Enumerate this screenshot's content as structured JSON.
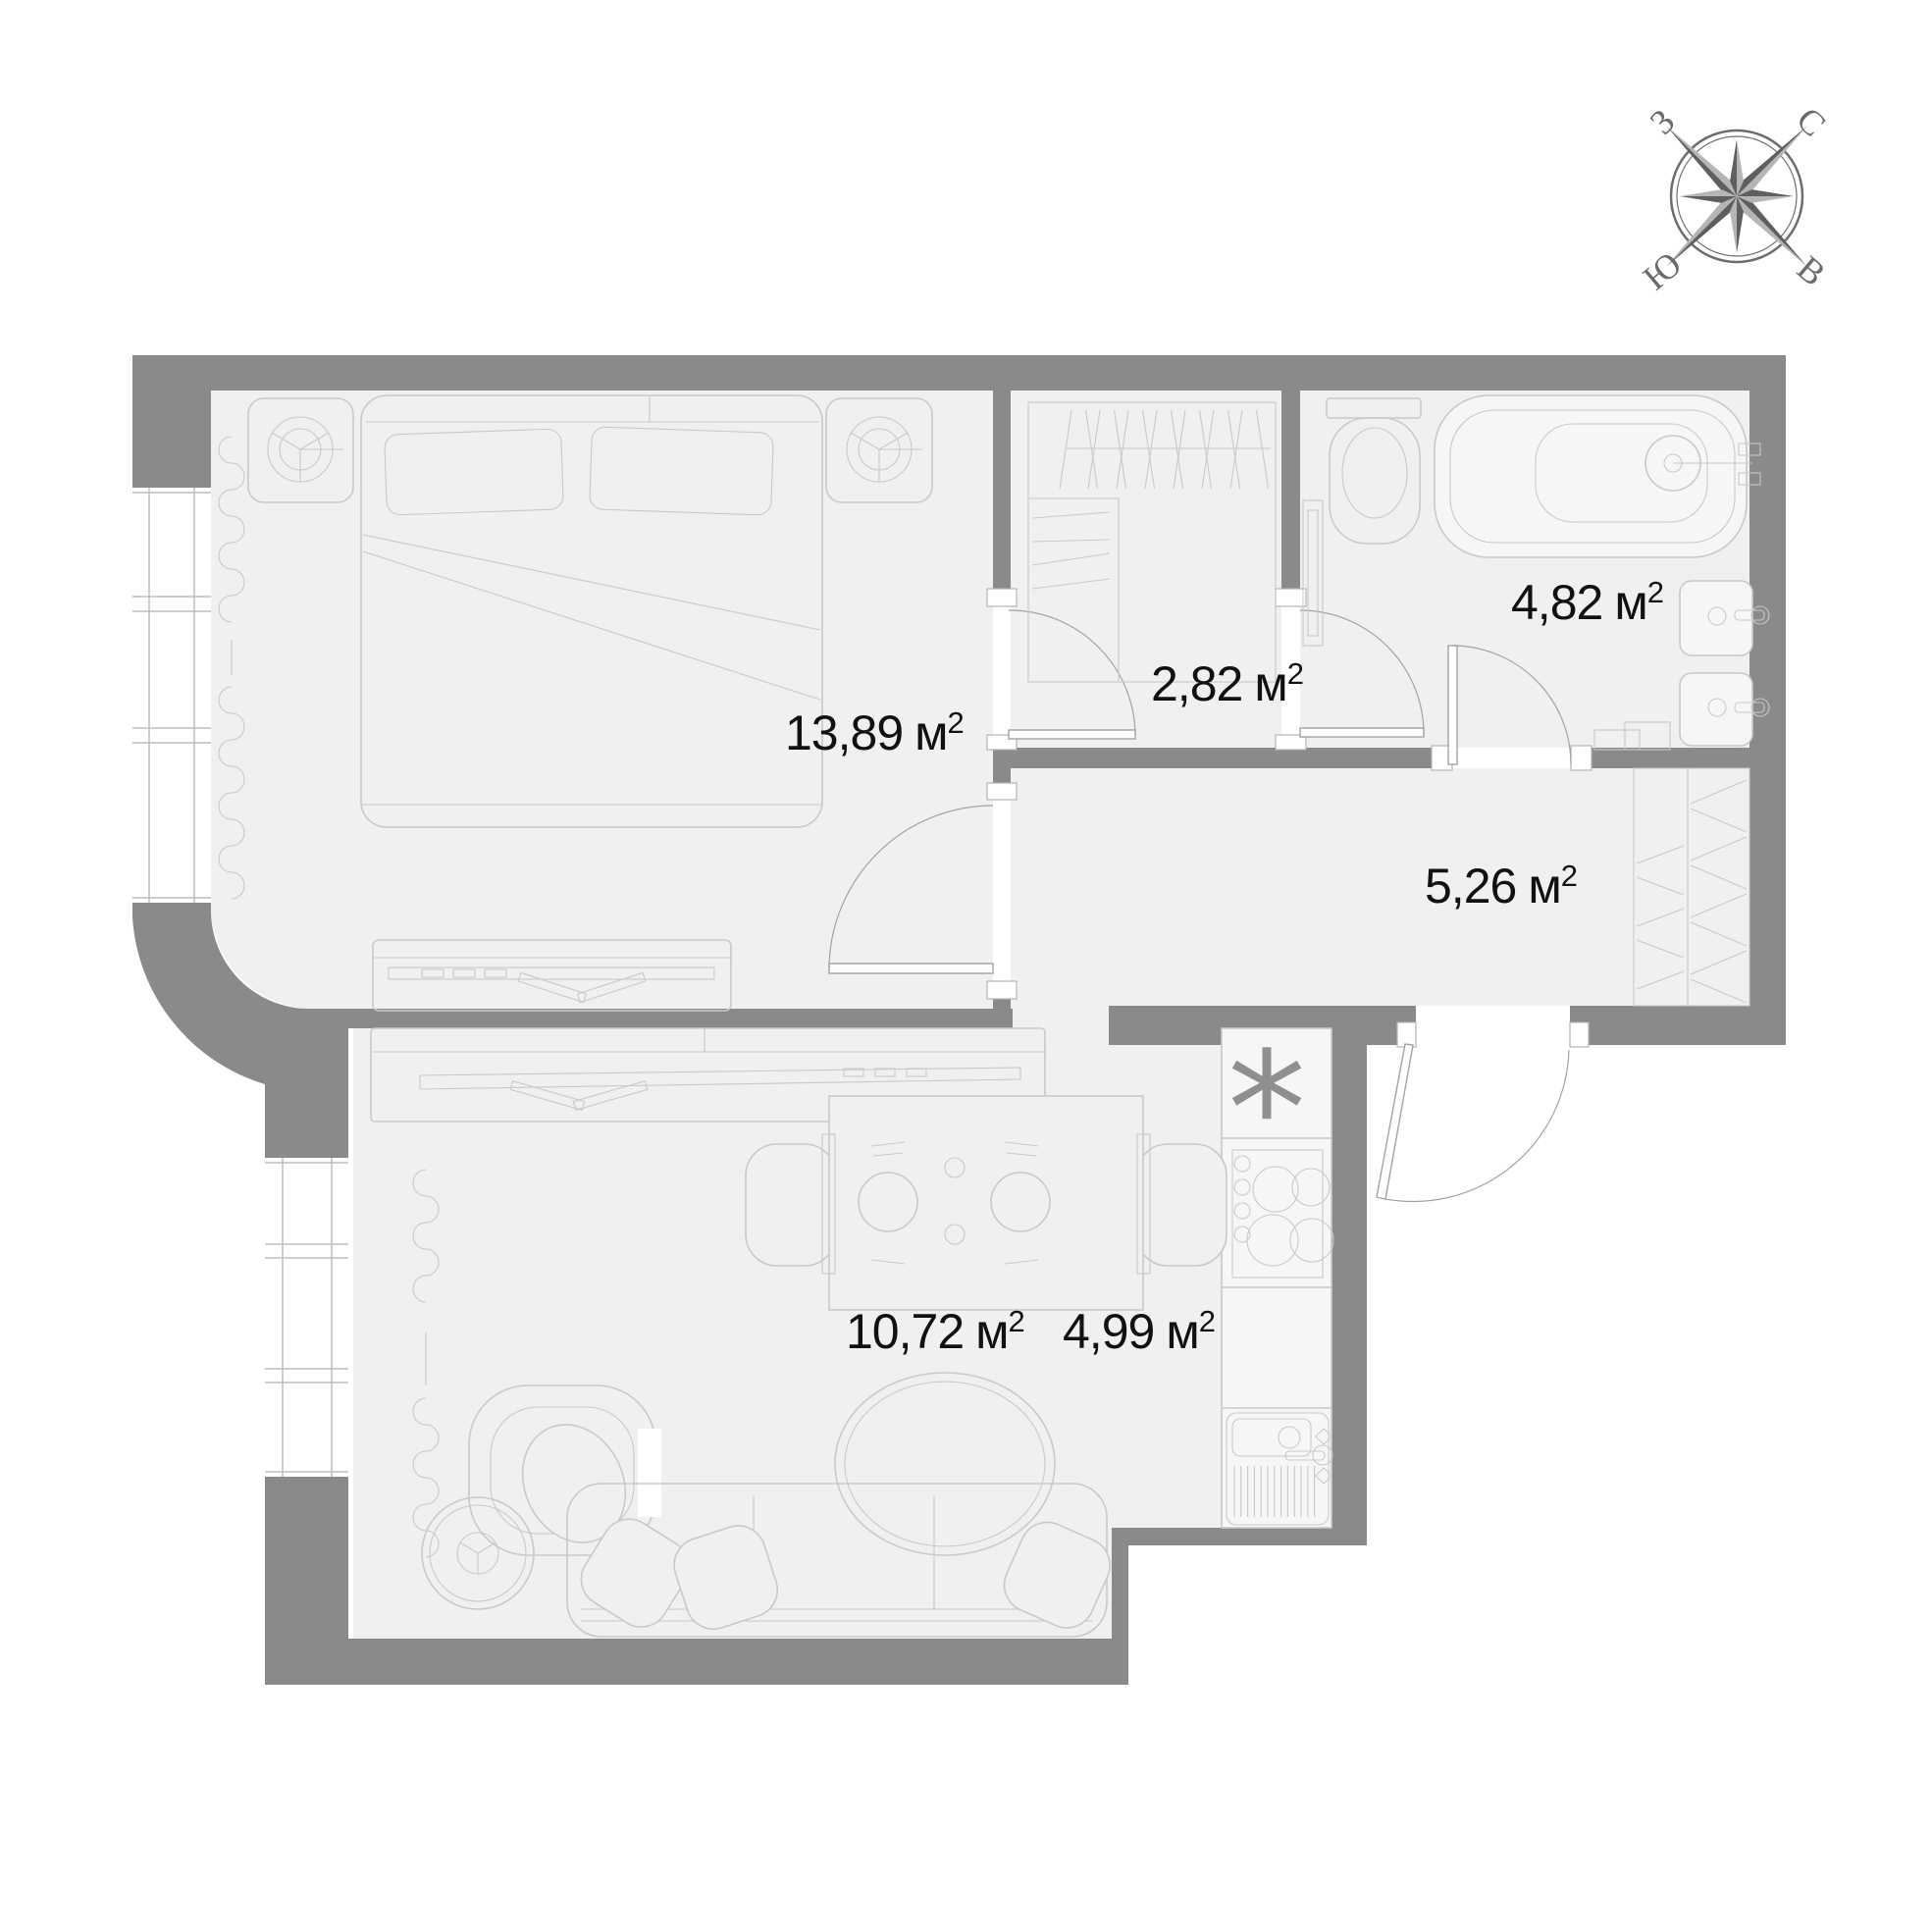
{
  "colors": {
    "background": "#ffffff",
    "wall": "#8a8a8a",
    "floor": "#f0f0f0",
    "fixture_fill": "#f6f6f6",
    "furniture_line": "#c9c9c9",
    "door_line": "#a3a3a3",
    "label_text": "#111111",
    "compass": "#6d6d6d"
  },
  "rooms": [
    {
      "id": "bedroom",
      "area": "13,89",
      "unit": "м",
      "exp": "2"
    },
    {
      "id": "wardrobe",
      "area": "2,82",
      "unit": "м",
      "exp": "2"
    },
    {
      "id": "bathroom",
      "area": "4,82",
      "unit": "м",
      "exp": "2"
    },
    {
      "id": "hallway",
      "area": "5,26",
      "unit": "м",
      "exp": "2"
    },
    {
      "id": "living-room",
      "area": "10,72",
      "unit": "м",
      "exp": "2"
    },
    {
      "id": "kitchen",
      "area": "4,99",
      "unit": "м",
      "exp": "2"
    }
  ],
  "compass": {
    "north": "С",
    "east": "В",
    "south": "Ю",
    "west": "З"
  },
  "kitchen": {
    "vent_symbol": "*"
  }
}
